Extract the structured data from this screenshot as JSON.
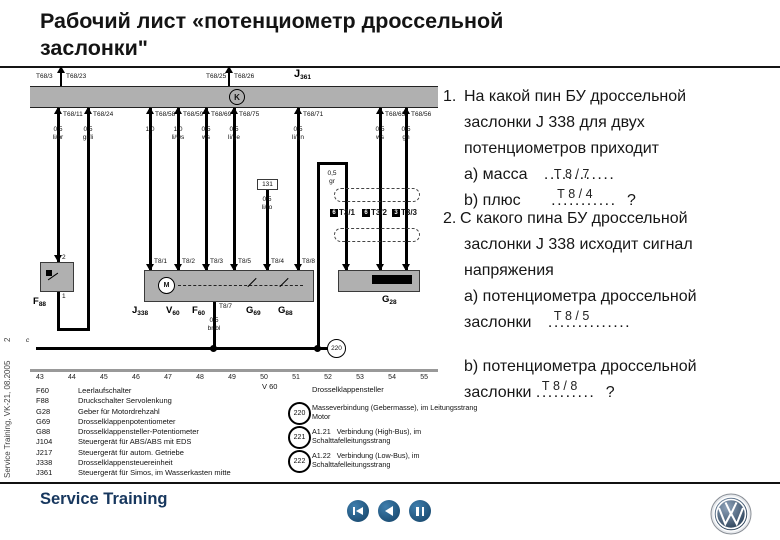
{
  "title": {
    "line1": "Рабочий лист «потенциометр дроссельной",
    "line2": "заслонки\""
  },
  "sidebar": {
    "page_number": "2",
    "vertical_text": "Service Training, VK-21, 08.2005"
  },
  "diagram": {
    "top": {
      "label_left": "T68/3",
      "stub1": "T68/23",
      "label_mid": "T68/25",
      "stub2": "T68/26",
      "ecu": {
        "p": "J",
        "s": "361"
      },
      "k_symbol": "K"
    },
    "pins": [
      {
        "pin": "T68/11",
        "sz": "0,5",
        "col": "li/br"
      },
      {
        "pin": "T68/24",
        "sz": "0,5",
        "col": "gr/li"
      },
      {
        "pin": "T68/58",
        "sz": "1,0",
        "col": "li"
      },
      {
        "pin": "T68/59",
        "sz": "1,0",
        "col": "li/ws"
      },
      {
        "pin": "T68/69",
        "sz": "0,5",
        "col": "ws"
      },
      {
        "pin": "T68/75",
        "sz": "0,5",
        "col": "li/ge"
      },
      {
        "pin": "T68/71",
        "sz": "0,5",
        "col": "li/gn"
      },
      {
        "pin": "T68/63",
        "sz": "0,5",
        "col": "ws"
      },
      {
        "pin": "T68/56",
        "sz": "0,5",
        "col": "gn"
      }
    ],
    "bridge131": {
      "label": "131",
      "sz": "0,5",
      "col": "li/ro"
    },
    "gr_wire": {
      "sz": "0,5",
      "col": "gr"
    },
    "j338": {
      "comp": {
        "p": "J",
        "s": "338"
      },
      "pins_top": [
        "T8/1",
        "T8/2",
        "T8/3",
        "T8/5",
        "T8/4",
        "T8/8"
      ],
      "pin_bottom": "T8/7",
      "sz": "0,5",
      "col": "br/bl",
      "motor": "M",
      "v60": {
        "p": "V",
        "s": "60"
      },
      "f60": {
        "p": "F",
        "s": "60"
      },
      "g69": {
        "p": "G",
        "s": "69"
      },
      "g88": {
        "p": "G",
        "s": "88"
      }
    },
    "f88": {
      "comp": {
        "p": "F",
        "s": "88"
      },
      "pin_top": "2",
      "pin_bottom": "1"
    },
    "g28": {
      "comp": {
        "p": "G",
        "s": "28"
      }
    },
    "t3": [
      {
        "sq": "6",
        "label": "T3/1"
      },
      {
        "sq": "6",
        "label": "T3/2"
      },
      {
        "sq": "3",
        "label": "T3/3"
      }
    ],
    "ground_circle": "220",
    "rail_marker": "c",
    "tracks": [
      "43",
      "44",
      "45",
      "46",
      "47",
      "48",
      "49",
      "50",
      "51",
      "52",
      "53",
      "54",
      "55"
    ]
  },
  "legend": {
    "items": [
      {
        "code": "F60",
        "desc": "Leerlaufschalter"
      },
      {
        "code": "F88",
        "desc": "Druckschalter Servolenkung"
      },
      {
        "code": "G28",
        "desc": "Geber für Motordrehzahl"
      },
      {
        "code": "G69",
        "desc": "Drosselklappenpotentiometer"
      },
      {
        "code": "G88",
        "desc": "Drosselklappensteller-Potentiometer"
      },
      {
        "code": "J104",
        "desc": "Steuergerät für ABS/ABS mit EDS"
      },
      {
        "code": "J217",
        "desc": "Steuergerät für autom. Getriebe"
      },
      {
        "code": "J338",
        "desc": "Drosselklappensteuereinheit"
      },
      {
        "code": "J361",
        "desc": "Steuergerät für Simos, im Wasserkasten mitte"
      }
    ],
    "v60_code": "V 60",
    "v60_desc": "Drosselklappensteller",
    "connections": [
      {
        "num": "220",
        "desc": "Masseverbindung (Gebermasse), im Leitungsstrang Motor"
      },
      {
        "num": "221",
        "desc": "A1.21   Verbindung (High-Bus), im Schalttafelleitungsstrang"
      },
      {
        "num": "222",
        "desc": "A1.22   Verbindung (Low-Bus), im Schalttafelleitungsstrang"
      }
    ]
  },
  "questions": {
    "q1": {
      "number": "1.",
      "line1": "На какой пин БУ дроссельной",
      "line2": "заслонки J 338 для двух",
      "line3": "потенциометров приходит",
      "a_label": "а) масса",
      "a_answer": "Т 8 / 7",
      "a_dots": "............",
      "b_label": "b) плюс",
      "b_answer": "Т 8 / 4",
      "b_dots": "...........",
      "suffix": "?"
    },
    "q2": {
      "number": "2.",
      "line1": "С какого пина БУ дроссельной",
      "line2": "заслонки J 338 исходит сигнал",
      "line3": "напряжения",
      "a_line1": "а) потенциометра дроссельной",
      "a_label": "заслонки",
      "a_answer": "Т 8 / 5",
      "a_dots": "..............",
      "b_line1": "b) потенциометра дроссельной",
      "b_label": "заслонки",
      "b_answer": "Т 8 / 8",
      "b_dots": "..........",
      "suffix": "?"
    }
  },
  "footer": {
    "brand": "Service Training",
    "nav_icons": [
      "skip-back",
      "step-back",
      "pause"
    ],
    "logo": "vw-logo"
  }
}
